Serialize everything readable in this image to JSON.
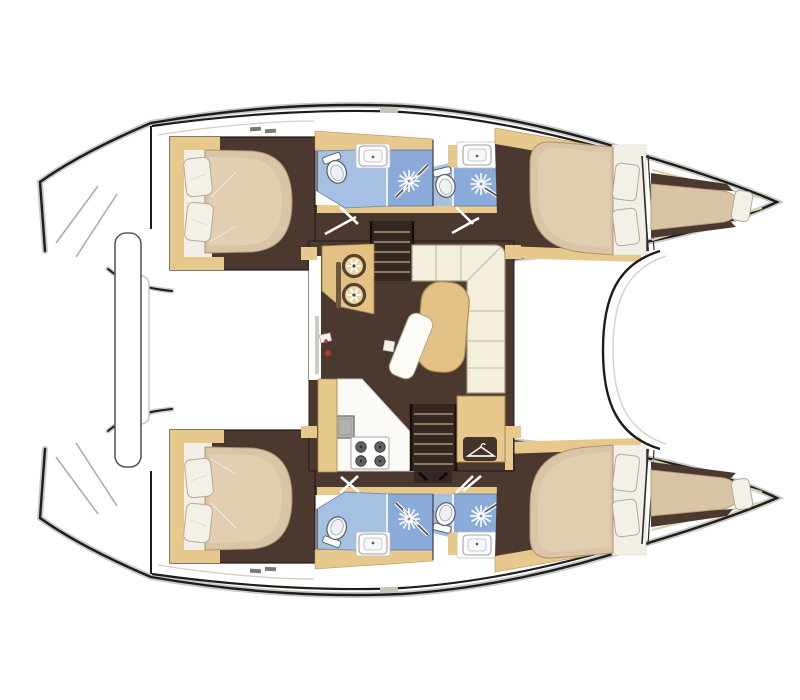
{
  "figure": {
    "type": "floor-plan",
    "subject": "catamaran-yacht-interior",
    "view": "top-down",
    "hulls": 2,
    "double_cabins": 4,
    "bathrooms": 4,
    "bow_berths": 2
  },
  "icons": {
    "shower": "sunburst-rays",
    "toilet": "oval-bowl-with-tank",
    "sink": "rounded-basin",
    "stove": "four-burner-hob",
    "galley_sink": "twin-round-bowls",
    "wardrobe": "clothes-hanger"
  },
  "colors": {
    "line": "#1d1d1b",
    "glow": "#c9c9c7",
    "floor": "#4b3930",
    "stairwell": "#352820",
    "tread": "#8d7a63",
    "cabinet": "#e8c98d",
    "counter": "#e3c183",
    "table": "#e4c287",
    "bed": "#d9c5a6",
    "bed_hi": "#e7d6b9",
    "linen": "#f2efe7",
    "pillow": "#f3f0e8",
    "pillow_line": "#b3ab99",
    "sofa": "#f4eedd",
    "sofa_line": "#a39781",
    "bath": "#a5c0e2",
    "shower": "#8aabd9",
    "bath_line": "#58749e",
    "fixture": "#5b656e",
    "white": "#ffffff",
    "appliance": "#b2b1ad",
    "red": "#b03a2e",
    "deck_line": "#d3cec4",
    "wood_line": "#a5824a",
    "hatch": "#e6e3dd",
    "dark_plate": "#43332a",
    "tan_edge": "#ddcda9",
    "burner": "#616161"
  }
}
